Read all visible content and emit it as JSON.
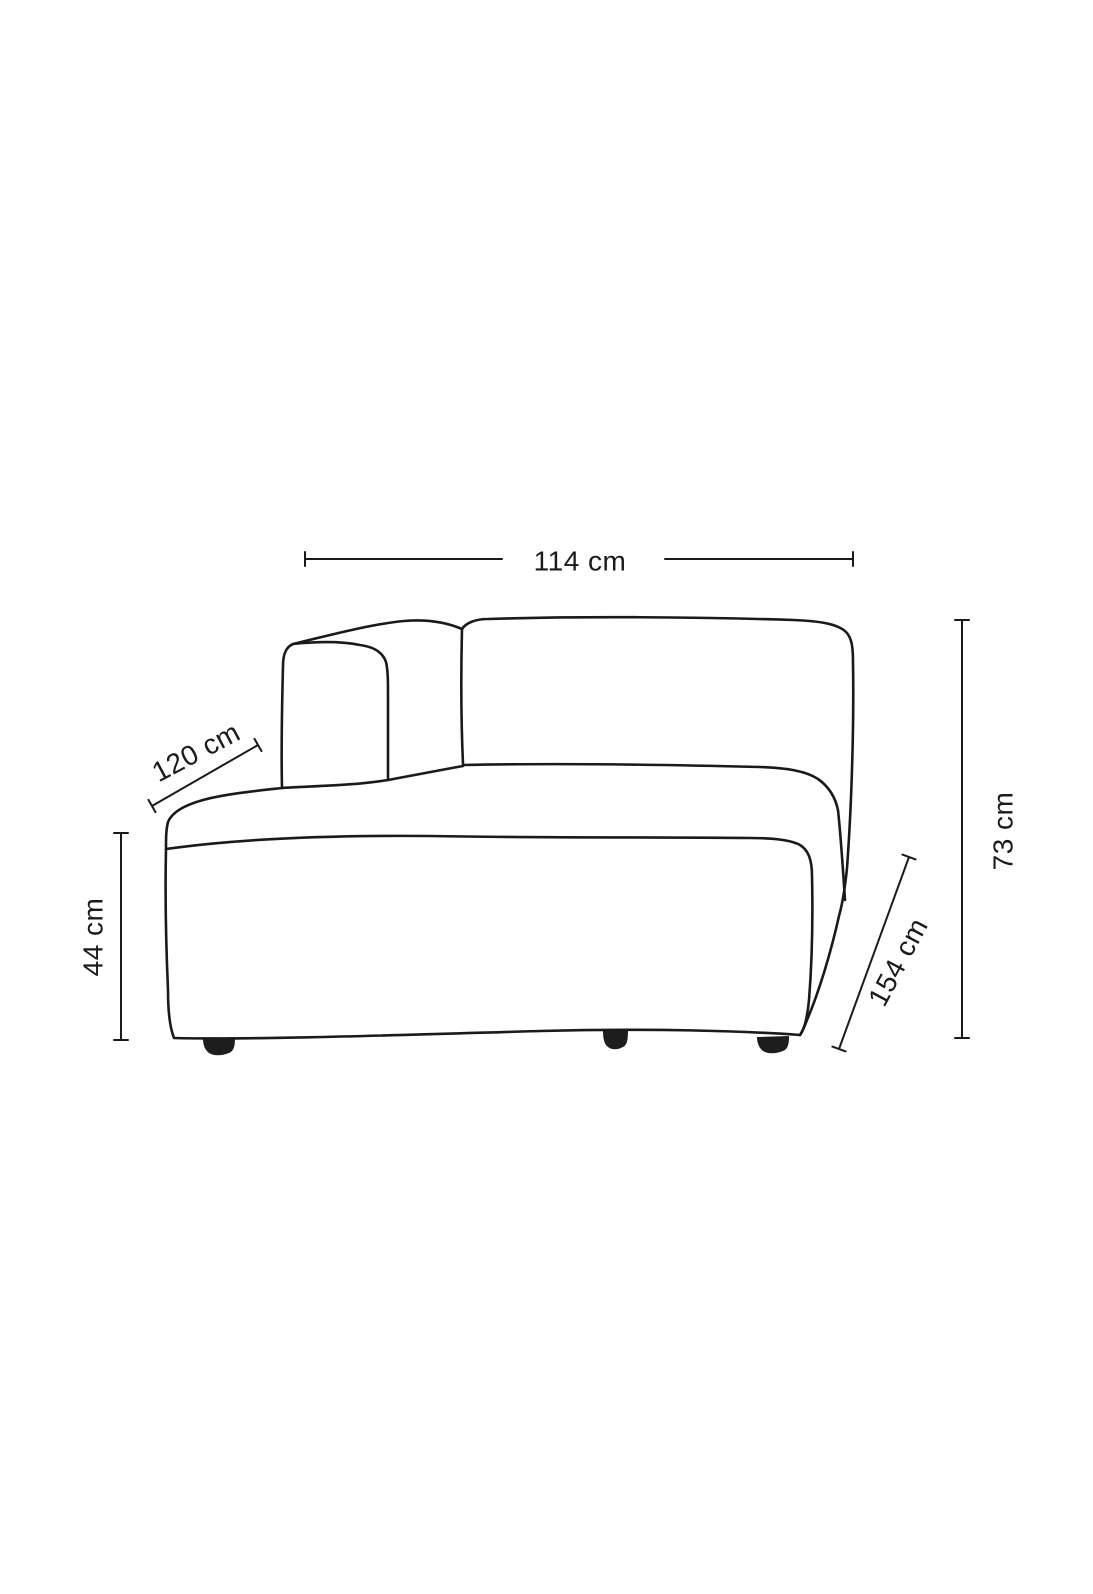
{
  "diagram": {
    "background_color": "#ffffff",
    "line_color": "#1a1a1a",
    "leg_color": "#1d1d1d",
    "drawing": "sofa-chaise-module-line-drawing",
    "dimensions": [
      {
        "name": "back-width",
        "label": "114 cm",
        "orientation": "horizontal"
      },
      {
        "name": "chaise-depth-left",
        "label": "120 cm",
        "orientation": "diagonal"
      },
      {
        "name": "seat-height",
        "label": "44 cm",
        "orientation": "vertical"
      },
      {
        "name": "side-depth-right",
        "label": "154 cm",
        "orientation": "diagonal"
      },
      {
        "name": "total-height",
        "label": "73 cm",
        "orientation": "vertical"
      }
    ]
  }
}
